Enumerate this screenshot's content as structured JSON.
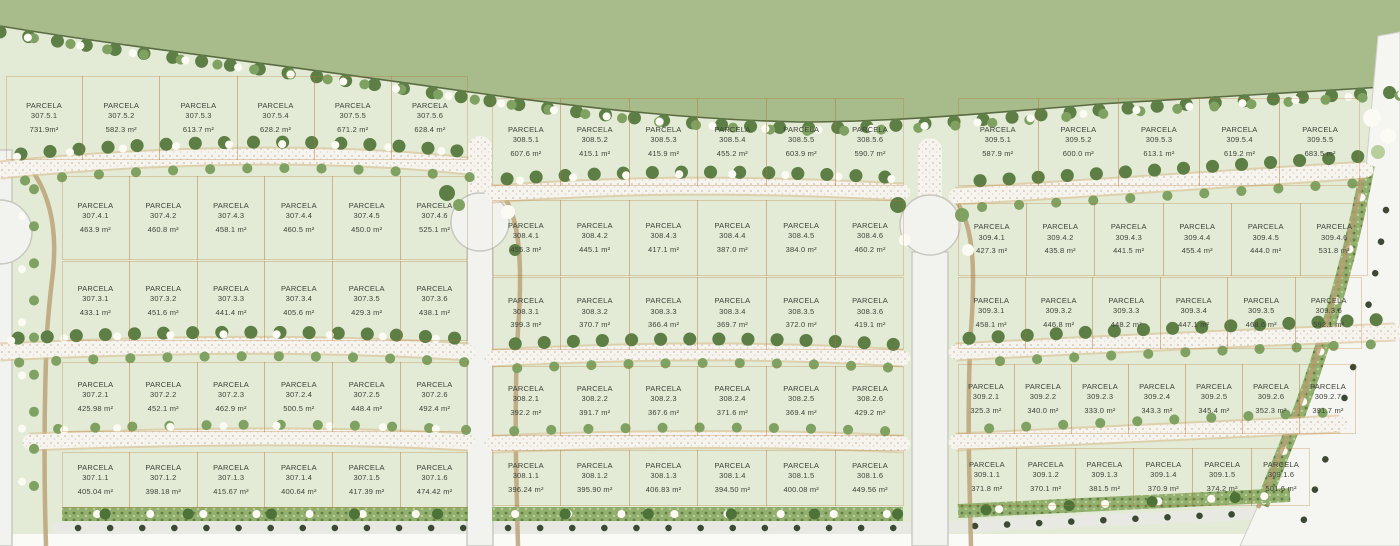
{
  "map": {
    "parcel_word": "PARCELA",
    "colors": {
      "open_space_green": "#a8bb8b",
      "field_green": "#e3ebd6",
      "road_white": "#f2f2ee",
      "path_tan": "#b89d72",
      "boundary_tan": "#c08a4e",
      "hedge_green": "#92af6e",
      "tree_green": "#5d7f46",
      "label_text": "#3e4237"
    },
    "blocks": [
      {
        "id": "307",
        "rows": [
          {
            "key": "307-5",
            "parcels": [
              {
                "id": "307.5.1",
                "area": "731.9m²"
              },
              {
                "id": "307.5.2",
                "area": "582.3 m²"
              },
              {
                "id": "307.5.3",
                "area": "613.7 m²"
              },
              {
                "id": "307.5.4",
                "area": "628.2 m²"
              },
              {
                "id": "307.5.5",
                "area": "671.2 m²"
              },
              {
                "id": "307.5.6",
                "area": "628.4 m²"
              }
            ]
          },
          {
            "key": "307-4",
            "parcels": [
              {
                "id": "307.4.1",
                "area": "463.9 m²"
              },
              {
                "id": "307.4.2",
                "area": "460.8 m²"
              },
              {
                "id": "307.4.3",
                "area": "458.1 m²"
              },
              {
                "id": "307.4.4",
                "area": "460.5 m²"
              },
              {
                "id": "307.4.5",
                "area": "450.0 m²"
              },
              {
                "id": "307.4.6",
                "area": "525.1 m²"
              }
            ]
          },
          {
            "key": "307-3",
            "parcels": [
              {
                "id": "307.3.1",
                "area": "433.1 m²"
              },
              {
                "id": "307.3.2",
                "area": "451.6 m²"
              },
              {
                "id": "307.3.3",
                "area": "441.4 m²"
              },
              {
                "id": "307.3.4",
                "area": "405.6 m²"
              },
              {
                "id": "307.3.5",
                "area": "429.3 m²"
              },
              {
                "id": "307.3.6",
                "area": "438.1 m²"
              }
            ]
          },
          {
            "key": "307-2",
            "parcels": [
              {
                "id": "307.2.1",
                "area": "425.98 m²"
              },
              {
                "id": "307.2.2",
                "area": "452.1 m²"
              },
              {
                "id": "307.2.3",
                "area": "462.9 m²"
              },
              {
                "id": "307.2.4",
                "area": "500.5 m²"
              },
              {
                "id": "307.2.5",
                "area": "448.4 m²"
              },
              {
                "id": "307.2.6",
                "area": "492.4 m²"
              }
            ]
          },
          {
            "key": "307-1",
            "parcels": [
              {
                "id": "307.1.1",
                "area": "405.04 m²"
              },
              {
                "id": "307.1.2",
                "area": "398.18 m²"
              },
              {
                "id": "307.1.3",
                "area": "415.67 m²"
              },
              {
                "id": "307.1.4",
                "area": "400.64 m²"
              },
              {
                "id": "307.1.5",
                "area": "417.39 m²"
              },
              {
                "id": "307.1.6",
                "area": "474.42 m²"
              }
            ]
          }
        ]
      },
      {
        "id": "308",
        "rows": [
          {
            "key": "308-5",
            "parcels": [
              {
                "id": "308.5.1",
                "area": "607.6 m²"
              },
              {
                "id": "308.5.2",
                "area": "415.1 m²"
              },
              {
                "id": "308.5.3",
                "area": "415.9 m²"
              },
              {
                "id": "308.5.4",
                "area": "455.2 m²"
              },
              {
                "id": "308.5.5",
                "area": "603.9 m²"
              },
              {
                "id": "308.5.6",
                "area": "590.7 m²"
              }
            ]
          },
          {
            "key": "308-4",
            "parcels": [
              {
                "id": "308.4.1",
                "area": "455.3 m²"
              },
              {
                "id": "308.4.2",
                "area": "445.1 m²"
              },
              {
                "id": "308.4.3",
                "area": "417.1 m²"
              },
              {
                "id": "308.4.4",
                "area": "387.0 m²"
              },
              {
                "id": "308.4.5",
                "area": "384.0 m²"
              },
              {
                "id": "308.4.6",
                "area": "460.2 m²"
              }
            ]
          },
          {
            "key": "308-3",
            "parcels": [
              {
                "id": "308.3.1",
                "area": "399.3 m²"
              },
              {
                "id": "308.3.2",
                "area": "370.7 m²"
              },
              {
                "id": "308.3.3",
                "area": "366.4 m²"
              },
              {
                "id": "308.3.4",
                "area": "369.7 m²"
              },
              {
                "id": "308.3.5",
                "area": "372.0 m²"
              },
              {
                "id": "308.3.6",
                "area": "419.1 m²"
              }
            ]
          },
          {
            "key": "308-2",
            "parcels": [
              {
                "id": "308.2.1",
                "area": "392.2 m²"
              },
              {
                "id": "308.2.2",
                "area": "391.7 m²"
              },
              {
                "id": "308.2.3",
                "area": "367.6 m²"
              },
              {
                "id": "308.2.4",
                "area": "371.6 m²"
              },
              {
                "id": "308.2.5",
                "area": "369.4 m²"
              },
              {
                "id": "308.2.6",
                "area": "429.2 m²"
              }
            ]
          },
          {
            "key": "308-1",
            "parcels": [
              {
                "id": "308.1.1",
                "area": "396.24 m²"
              },
              {
                "id": "308.1.2",
                "area": "395.90 m²"
              },
              {
                "id": "308.1.3",
                "area": "406.83 m²"
              },
              {
                "id": "308.1.4",
                "area": "394.50 m²"
              },
              {
                "id": "308.1.5",
                "area": "400.08 m²"
              },
              {
                "id": "308.1.6",
                "area": "449.56 m²"
              }
            ]
          }
        ]
      },
      {
        "id": "309",
        "rows": [
          {
            "key": "309-5",
            "parcels": [
              {
                "id": "309.5.1",
                "area": "587.9 m²"
              },
              {
                "id": "309.5.2",
                "area": "600.0 m²"
              },
              {
                "id": "309.5.3",
                "area": "613.1 m²"
              },
              {
                "id": "309.5.4",
                "area": "619.2 m²"
              },
              {
                "id": "309.5.5",
                "area": "683.5 m²"
              }
            ]
          },
          {
            "key": "309-4",
            "parcels": [
              {
                "id": "309.4.1",
                "area": "427.3 m²"
              },
              {
                "id": "309.4.2",
                "area": "435.8 m²"
              },
              {
                "id": "309.4.3",
                "area": "441.5 m²"
              },
              {
                "id": "309.4.4",
                "area": "455.4 m²"
              },
              {
                "id": "309.4.5",
                "area": "444.0 m²"
              },
              {
                "id": "309.4.6",
                "area": "531.8 m²"
              }
            ]
          },
          {
            "key": "309-3",
            "parcels": [
              {
                "id": "309.3.1",
                "area": "458.1 m²"
              },
              {
                "id": "309.3.2",
                "area": "446.8 m²"
              },
              {
                "id": "309.3.3",
                "area": "448.2 m²"
              },
              {
                "id": "309.3.4",
                "area": "447.1 m²"
              },
              {
                "id": "309.3.5",
                "area": "468.6 m²"
              },
              {
                "id": "309.3.6",
                "area": "592.1 m²"
              }
            ]
          },
          {
            "key": "309-2",
            "parcels": [
              {
                "id": "309.2.1",
                "area": "325.3 m²"
              },
              {
                "id": "309.2.2",
                "area": "340.0 m²"
              },
              {
                "id": "309.2.3",
                "area": "333.0 m²"
              },
              {
                "id": "309.2.4",
                "area": "343.3 m²"
              },
              {
                "id": "309.2.5",
                "area": "345.4 m²"
              },
              {
                "id": "309.2.6",
                "area": "352.3 m²"
              },
              {
                "id": "309.2.7",
                "area": "391.7 m²"
              }
            ]
          },
          {
            "key": "309-1",
            "parcels": [
              {
                "id": "309.1.1",
                "area": "371.8 m²"
              },
              {
                "id": "309.1.2",
                "area": "370.1 m²"
              },
              {
                "id": "309.1.3",
                "area": "381.5 m²"
              },
              {
                "id": "309.1.4",
                "area": "370.9 m²"
              },
              {
                "id": "309.1.5",
                "area": "374.2 m²"
              },
              {
                "id": "309.1.6",
                "area": "501.6 m²"
              }
            ]
          }
        ]
      }
    ]
  }
}
